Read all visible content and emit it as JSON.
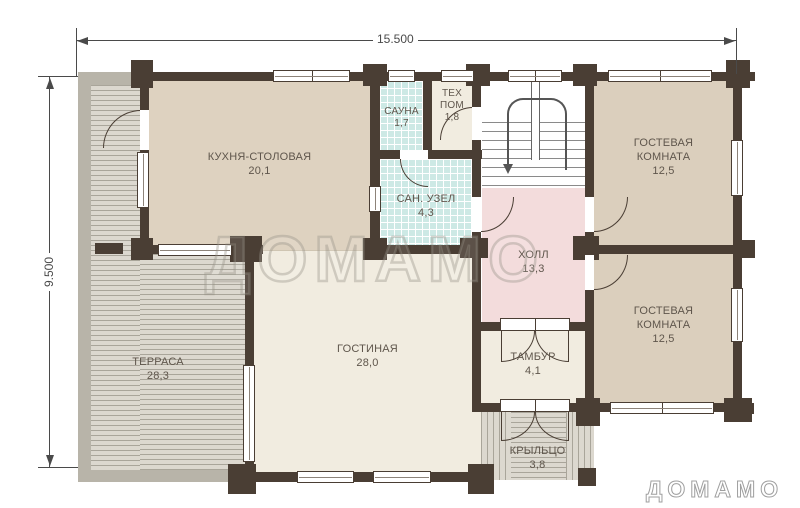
{
  "dimensions": {
    "width_label": "15.500",
    "height_label": "9.500"
  },
  "rooms": {
    "kitchen": {
      "label": "КУХНЯ-СТОЛОВАЯ",
      "area": "20,1"
    },
    "sauna": {
      "label": "САУНА",
      "area": "1,7"
    },
    "tech": {
      "line1": "ТЕХ",
      "line2": "ПОМ",
      "area": "1,8"
    },
    "bathroom": {
      "label": "САН. УЗЕЛ",
      "area": "4,3"
    },
    "hall": {
      "label": "ХОЛЛ",
      "area": "13,3"
    },
    "guest1": {
      "line1": "ГОСТЕВАЯ",
      "line2": "КОМНАТА",
      "area": "12,5"
    },
    "guest2": {
      "line1": "ГОСТЕВАЯ",
      "line2": "КОМНАТА",
      "area": "12,5"
    },
    "living": {
      "label": "ГОСТИНАЯ",
      "area": "28,0"
    },
    "terrace": {
      "label": "ТЕРРАСА",
      "area": "28,3"
    },
    "vestibule": {
      "label": "ТАМБУР",
      "area": "4,1"
    },
    "porch": {
      "label": "КРЫЛЬЦО",
      "area": "3,8"
    }
  },
  "watermark": "ДОМАМО",
  "logo": "ДОМАМО",
  "colors": {
    "wall": "#4a3e34",
    "floor-beige": "#ded2c0",
    "floor-tan": "#dbcfbd",
    "floor-cream": "#f1ece0",
    "floor-pink": "#f3dcdc",
    "tile": "#cde9e5",
    "deck-bg": "#dcd8cf",
    "deck-line": "#a9a59a",
    "deck-band": "#b8b4a9",
    "label": "#5f564c",
    "dim": "#4a4a4a"
  }
}
